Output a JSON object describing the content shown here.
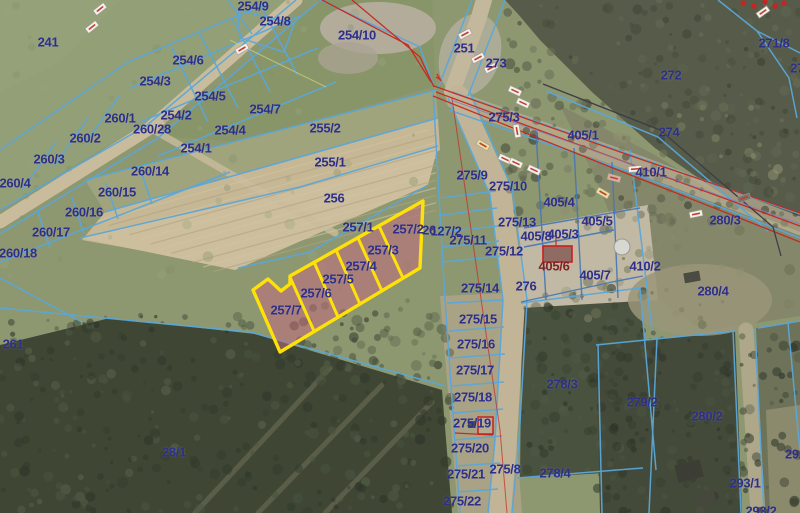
{
  "map": {
    "type": "cadastral-parcel-map-over-orthophoto",
    "label_color": "#2f2f8a",
    "selected_label_color": "#7e2222",
    "parcel_line_color": "#5aa7da",
    "parcel_line_color_dark": "#4879b4",
    "utility_line_color": "#c5291f",
    "cable_line_color": "#3e3e46",
    "highlight_outline_color": "#ffe10a",
    "highlight_fill_color": "#c4697f",
    "highlighted_parcels": [
      "257/2",
      "257/3",
      "257/4",
      "257/5",
      "257/6",
      "257/7"
    ],
    "labels": [
      {
        "text": "241",
        "x": 48,
        "y": 42
      },
      {
        "text": "254/9",
        "x": 253,
        "y": 6
      },
      {
        "text": "254/8",
        "x": 275,
        "y": 21
      },
      {
        "text": "254/10",
        "x": 357,
        "y": 35
      },
      {
        "text": "254/6",
        "x": 188,
        "y": 60
      },
      {
        "text": "254/3",
        "x": 155,
        "y": 81
      },
      {
        "text": "254/5",
        "x": 210,
        "y": 96
      },
      {
        "text": "254/2",
        "x": 176,
        "y": 115
      },
      {
        "text": "254/7",
        "x": 265,
        "y": 109
      },
      {
        "text": "254/4",
        "x": 230,
        "y": 130
      },
      {
        "text": "254/1",
        "x": 196,
        "y": 148
      },
      {
        "text": "260/1",
        "x": 120,
        "y": 118
      },
      {
        "text": "260/28",
        "x": 152,
        "y": 129
      },
      {
        "text": "260/2",
        "x": 85,
        "y": 138
      },
      {
        "text": "260/3",
        "x": 49,
        "y": 159
      },
      {
        "text": "260/4",
        "x": 15,
        "y": 183
      },
      {
        "text": "260/14",
        "x": 150,
        "y": 171
      },
      {
        "text": "260/15",
        "x": 117,
        "y": 192
      },
      {
        "text": "260/16",
        "x": 84,
        "y": 212
      },
      {
        "text": "260/17",
        "x": 51,
        "y": 232
      },
      {
        "text": "260/18",
        "x": 18,
        "y": 253
      },
      {
        "text": "251",
        "x": 464,
        "y": 48
      },
      {
        "text": "273",
        "x": 496,
        "y": 63
      },
      {
        "text": "272",
        "x": 671,
        "y": 75
      },
      {
        "text": "271/8",
        "x": 774,
        "y": 43
      },
      {
        "text": "27",
        "x": 797,
        "y": 68
      },
      {
        "text": "274",
        "x": 669,
        "y": 132
      },
      {
        "text": "255/2",
        "x": 325,
        "y": 128
      },
      {
        "text": "255/1",
        "x": 330,
        "y": 162
      },
      {
        "text": "256",
        "x": 334,
        "y": 198
      },
      {
        "text": "275/3",
        "x": 504,
        "y": 117
      },
      {
        "text": "405/1",
        "x": 583,
        "y": 135
      },
      {
        "text": "275/9",
        "x": 472,
        "y": 175
      },
      {
        "text": "275/10",
        "x": 508,
        "y": 186
      },
      {
        "text": "410/1",
        "x": 651,
        "y": 172
      },
      {
        "text": "405/4",
        "x": 559,
        "y": 202
      },
      {
        "text": "405/5",
        "x": 597,
        "y": 221
      },
      {
        "text": "280/3",
        "x": 725,
        "y": 220
      },
      {
        "text": "275/13",
        "x": 517,
        "y": 222
      },
      {
        "text": "405/8",
        "x": 536,
        "y": 236
      },
      {
        "text": "405/3",
        "x": 563,
        "y": 234
      },
      {
        "text": "26",
        "x": 429,
        "y": 230
      },
      {
        "text": "127/2",
        "x": 446,
        "y": 231
      },
      {
        "text": "257/2",
        "x": 408,
        "y": 229
      },
      {
        "text": "275/11",
        "x": 468,
        "y": 240
      },
      {
        "text": "275/12",
        "x": 504,
        "y": 251
      },
      {
        "text": "405/6",
        "x": 554,
        "y": 266,
        "color": "#7e2222"
      },
      {
        "text": "405/7",
        "x": 595,
        "y": 275
      },
      {
        "text": "410/2",
        "x": 645,
        "y": 266
      },
      {
        "text": "276",
        "x": 526,
        "y": 286
      },
      {
        "text": "280/4",
        "x": 713,
        "y": 291
      },
      {
        "text": "275/14",
        "x": 480,
        "y": 288
      },
      {
        "text": "257/1",
        "x": 358,
        "y": 227
      },
      {
        "text": "257/3",
        "x": 383,
        "y": 250
      },
      {
        "text": "257/4",
        "x": 361,
        "y": 266
      },
      {
        "text": "257/5",
        "x": 338,
        "y": 279
      },
      {
        "text": "257/6",
        "x": 316,
        "y": 293
      },
      {
        "text": "257/7",
        "x": 286,
        "y": 310
      },
      {
        "text": "275/15",
        "x": 478,
        "y": 319
      },
      {
        "text": "275/16",
        "x": 476,
        "y": 344
      },
      {
        "text": "275/17",
        "x": 475,
        "y": 370
      },
      {
        "text": "275/18",
        "x": 473,
        "y": 397
      },
      {
        "text": "275/19",
        "x": 472,
        "y": 423
      },
      {
        "text": "275/20",
        "x": 470,
        "y": 448
      },
      {
        "text": "275/21",
        "x": 466,
        "y": 474
      },
      {
        "text": "275/22",
        "x": 462,
        "y": 501
      },
      {
        "text": "275/8",
        "x": 505,
        "y": 469
      },
      {
        "text": "278/3",
        "x": 562,
        "y": 384
      },
      {
        "text": "278/4",
        "x": 555,
        "y": 473
      },
      {
        "text": "279/2",
        "x": 642,
        "y": 402
      },
      {
        "text": "280/2",
        "x": 707,
        "y": 416
      },
      {
        "text": "293/1",
        "x": 745,
        "y": 483
      },
      {
        "text": "292/",
        "x": 797,
        "y": 454
      },
      {
        "text": "293/2",
        "x": 761,
        "y": 511
      },
      {
        "text": "261",
        "x": 13,
        "y": 344
      },
      {
        "text": "28/1",
        "x": 174,
        "y": 452
      }
    ]
  }
}
